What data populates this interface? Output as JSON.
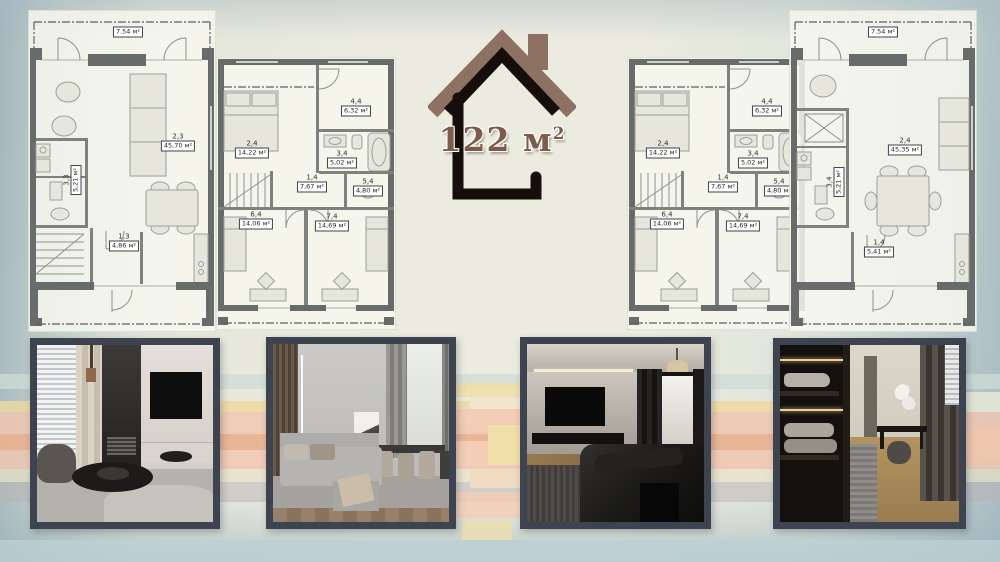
{
  "logo": {
    "area_main": "122 м",
    "area_sup": "2"
  },
  "plans": [
    {
      "name": "ground-floor-plan-left",
      "balcony_area": "7.54 м²",
      "rooms": [
        {
          "code": "2,3",
          "area": "45,70 м²"
        },
        {
          "code": "3,3",
          "area": "5,21 м²"
        },
        {
          "code": "1,3",
          "area": "4,86 м²"
        }
      ]
    },
    {
      "name": "upper-floor-plan-left",
      "rooms": [
        {
          "code": "2,4",
          "area": "14,22 м²"
        },
        {
          "code": "4,4",
          "area": "6,32 м²"
        },
        {
          "code": "3,4",
          "area": "5,02 м²"
        },
        {
          "code": "1,4",
          "area": "7,67 м²"
        },
        {
          "code": "5,4",
          "area": "4,80 м²"
        },
        {
          "code": "6,4",
          "area": "14,06 м²"
        },
        {
          "code": "7,4",
          "area": "14,69 м²"
        }
      ]
    },
    {
      "name": "upper-floor-plan-right",
      "rooms": [
        {
          "code": "2,4",
          "area": "14,22 м²"
        },
        {
          "code": "4,4",
          "area": "6,32 м²"
        },
        {
          "code": "3,4",
          "area": "5,02 м²"
        },
        {
          "code": "1,4",
          "area": "7,67 м²"
        },
        {
          "code": "5,4",
          "area": "4,80 м²"
        },
        {
          "code": "6,4",
          "area": "14,06 м²"
        },
        {
          "code": "7,4",
          "area": "14,69 м²"
        }
      ]
    },
    {
      "name": "ground-floor-plan-right",
      "balcony_area": "7.54 м²",
      "rooms": [
        {
          "code": "2,4",
          "area": "45,35 м²"
        },
        {
          "code": "3,4",
          "area": "5,21 м²"
        },
        {
          "code": "1,4",
          "area": "5,41 м²"
        }
      ]
    }
  ],
  "photos": [
    {
      "label": "living-room-round-table-render"
    },
    {
      "label": "lounge-dining-room-render"
    },
    {
      "label": "dark-bedroom-render"
    },
    {
      "label": "wardrobe-vanity-render"
    }
  ],
  "colors": {
    "roof_brown": "#8d7162",
    "outline_black": "#150e0b",
    "logo_text_brown": "#7d5c4b",
    "photo_frame": "#3d4450",
    "stripe_gold": "#eeda9e",
    "stripe_salmon": "#f1c6b0",
    "stripe_orange": "#e4a47d",
    "stripe_blue": "#cfdcd6"
  }
}
